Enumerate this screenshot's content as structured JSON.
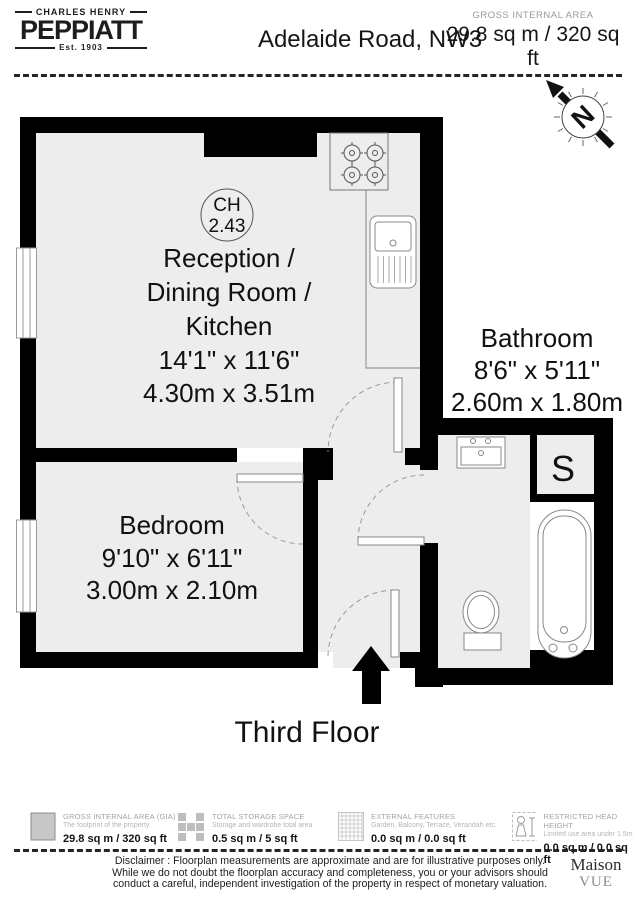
{
  "header": {
    "logo_top": "CHARLES HENRY",
    "logo_name": "PEPPIATT",
    "logo_est": "Est. 1903",
    "address": "Adelaide Road, NW3",
    "gia_label": "GROSS INTERNAL AREA",
    "gia_value": "29.8 sq m / 320 sq ft"
  },
  "compass": {
    "n": "N"
  },
  "plan": {
    "reception": {
      "ch_label": "CH",
      "ch_value": "2.43",
      "name_line1": "Reception /",
      "name_line2": "Dining Room /",
      "name_line3": "Kitchen",
      "imperial": "14'1\" x 11'6\"",
      "metric": "4.30m x 3.51m"
    },
    "bathroom": {
      "name": "Bathroom",
      "imperial": "8'6\" x 5'11\"",
      "metric": "2.60m x 1.80m"
    },
    "bedroom": {
      "name": "Bedroom",
      "imperial": "9'10\" x 6'11\"",
      "metric": "3.00m x 2.10m"
    },
    "storage_label": "S",
    "floor_label": "Third Floor"
  },
  "legend": [
    {
      "icon": "solid-square-icon",
      "name": "GROSS INTERNAL AREA (GIA)",
      "desc": "The footprint of the property",
      "value": "29.8 sq m / 320 sq ft"
    },
    {
      "icon": "storage-blocks-icon",
      "name": "TOTAL STORAGE SPACE",
      "desc": "Storage and wardrobe total area",
      "value": "0.5 sq m / 5 sq ft"
    },
    {
      "icon": "hatch-square-icon",
      "name": "EXTERNAL FEATURES",
      "desc": "Garden, Balcony, Terrace, Verandah etc.",
      "value": "0.0 sq m / 0.0 sq ft"
    },
    {
      "icon": "person-icon",
      "name": "RESTRICTED HEAD HEIGHT",
      "desc": "Limited use area under 1.5m",
      "value": "0.0 sq m / 0.0 sq ft"
    }
  ],
  "footer": {
    "disclaimer_line1": "Disclaimer : Floorplan measurements are approximate and are for illustrative purposes only.",
    "disclaimer_line2": "While we do not doubt the floorplan accuracy and completeness, you or your advisors should",
    "disclaimer_line3": "conduct a careful, independent investigation of the property in respect of monetary valuation.",
    "maison_line1": "Maison",
    "maison_line2": "VUE"
  },
  "colors": {
    "wall": "#000000",
    "floor": "#ededed",
    "fixture_stroke": "#888888"
  }
}
